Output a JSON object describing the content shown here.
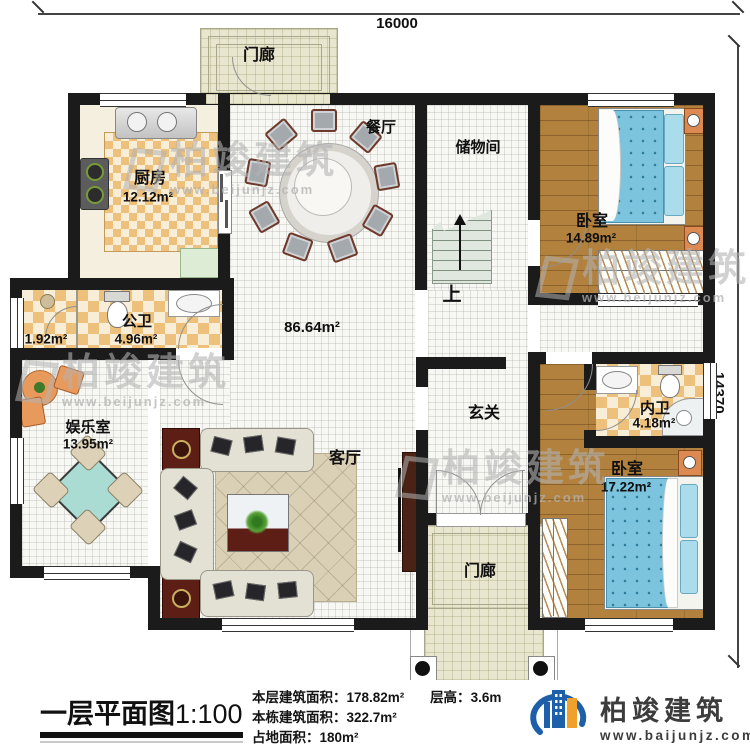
{
  "dimensions": {
    "top": "16000",
    "right": "14370"
  },
  "rooms": {
    "porch_top": {
      "name": "门廊"
    },
    "kitchen": {
      "name": "厨房",
      "area": "12.12m²"
    },
    "dining": {
      "name": "餐厅"
    },
    "storage": {
      "name": "储物间"
    },
    "bedroom1": {
      "name": "卧室",
      "area": "14.89m²"
    },
    "stairs_up": "上",
    "hall_area": "86.64m²",
    "bath_public": {
      "name": "公卫",
      "area": "4.96m²",
      "sub_area": "1.92m²"
    },
    "entertainment": {
      "name": "娱乐室",
      "area": "13.95m²"
    },
    "living": {
      "name": "客厅"
    },
    "foyer": {
      "name": "玄关"
    },
    "bath_private": {
      "name": "内卫",
      "area": "4.18m²"
    },
    "bedroom2": {
      "name": "卧室",
      "area": "17.22m²"
    },
    "porch_bottom": {
      "name": "门廊"
    }
  },
  "footer": {
    "title": "一层平面图",
    "scale": "1:100",
    "stats": [
      {
        "label": "本层建筑面积：",
        "value": "178.82m²"
      },
      {
        "label": "本栋建筑面积：",
        "value": "322.7m²"
      },
      {
        "label": "占地面积：",
        "value": "180m²"
      }
    ],
    "floor_height": {
      "label": "层高：",
      "value": "3.6m"
    }
  },
  "branding": {
    "logo_text": "柏竣建筑",
    "logo_url": "www.baijunjz.com"
  },
  "watermark": {
    "text": "柏竣建筑",
    "url": "www.beijunjz.com"
  },
  "colors": {
    "wall": "#1b1b1b",
    "wood_floor": "#b2813e",
    "tile": "#edc17c",
    "bed": "#7cc3dd",
    "table_teal": "#abdcd3",
    "logo_blue": "#1d5fa8",
    "logo_orange": "#f0a12c",
    "watermark": "#b4b4b4"
  }
}
